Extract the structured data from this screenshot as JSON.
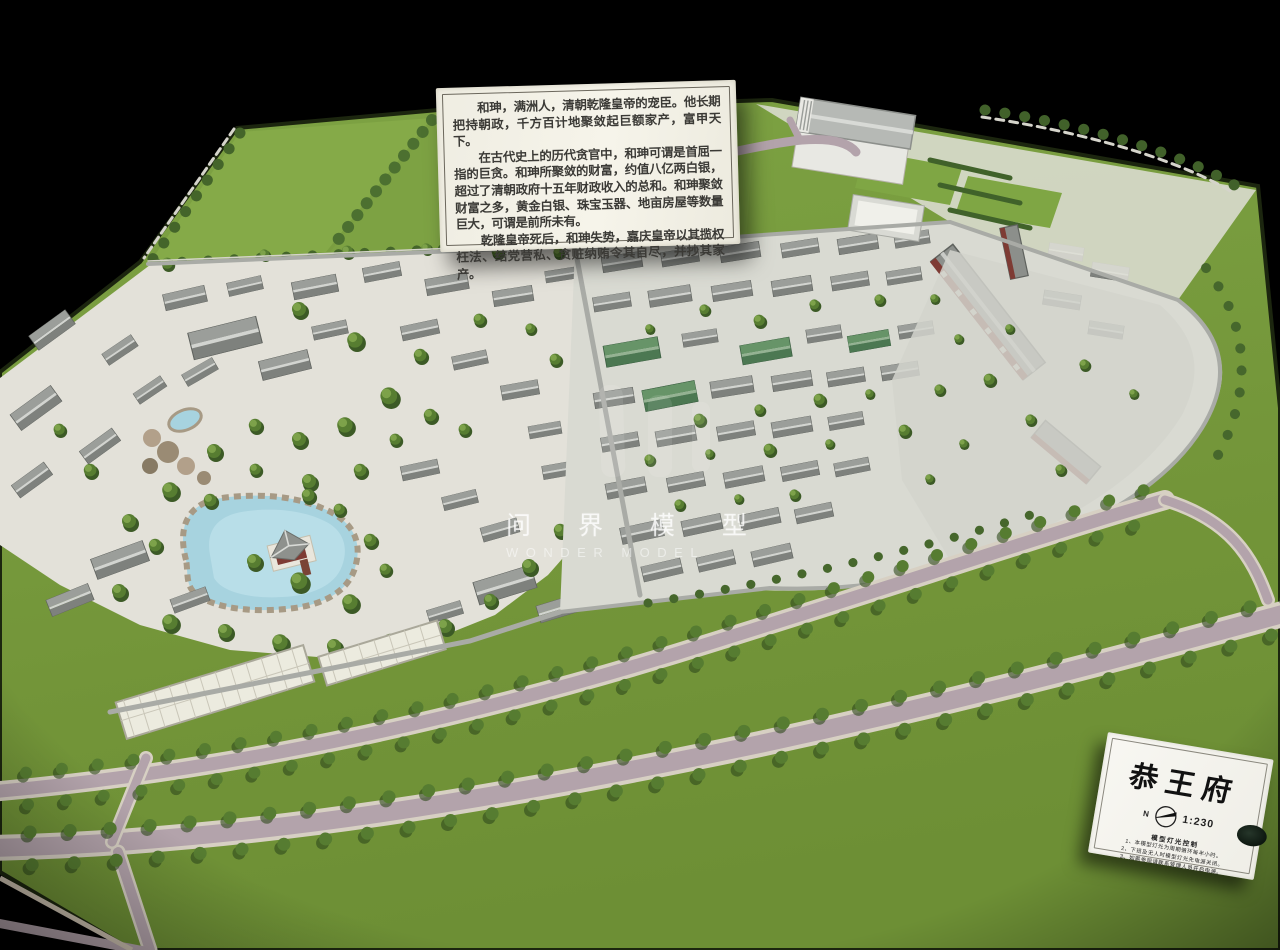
{
  "scene": {
    "description": "Photograph of a physical architectural scale model of Prince Gong's Mansion on a black background",
    "palette": {
      "background": "#000000",
      "grass": "#76993c",
      "lawn": "#83a847",
      "road": "#b3a3ab",
      "road_edge": "#d7d0c3",
      "gravel": "#e4e2da",
      "roof_gray": "#8f928e",
      "roof_green": "#5c8a62",
      "wall_gray": "#a9aba6",
      "water": "#a7d3df",
      "rock_tan": "#b2a08a",
      "tree_green": "#53762f",
      "red_accent": "#7e3b34",
      "paper": "#f4f2ea"
    }
  },
  "info_placard": {
    "paragraphs": [
      "和珅，满洲人，清朝乾隆皇帝的宠臣。他长期把持朝政，千方百计地聚敛起巨额家产，富甲天下。",
      "在古代史上的历代贪官中，和珅可谓是首屈一指的巨贪。和珅所聚敛的财富，约值八亿两白银，超过了清朝政府十五年财政收入的总和。和珅聚敛财富之多，黄金白银、珠宝玉器、地亩房屋等数量巨大，可谓是前所未有。",
      "乾隆皇帝死后，和珅失势，嘉庆皇帝以其揽权枉法、结党营私、贪赃纳贿令其自尽，并抄其家产。"
    ]
  },
  "watermark": {
    "chinese": "问 界 模 型",
    "english": "WONDER MODEL"
  },
  "title_card": {
    "title": "恭王府",
    "north_label": "N",
    "scale": "1:230",
    "lighting_title": "模型灯光控制",
    "lighting_notes": [
      "1、本模型灯光为周期循环每半小时。",
      "2、下班及无人时模型灯光先电源关闭。",
      "3、如需参观请联系管理人员开启电源。"
    ]
  }
}
